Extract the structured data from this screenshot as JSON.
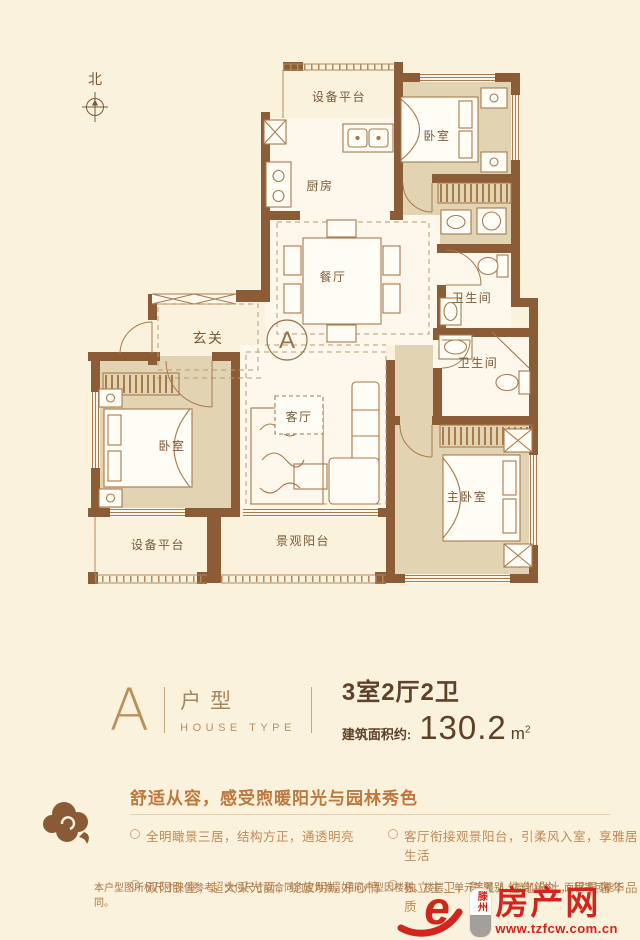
{
  "plan": {
    "compass": "北",
    "marker": "A",
    "rooms": {
      "equip_top": "设备平台",
      "kitchen": "厨房",
      "bedroom_tr": "卧室",
      "dining": "餐厅",
      "foyer": "玄关",
      "bath_1": "卫生间",
      "bath_2": "卫生间",
      "living": "客厅",
      "bedroom_left": "卧室",
      "master": "主卧室",
      "equip_bottom": "设备平台",
      "balcony": "景观阳台"
    }
  },
  "info": {
    "type_letter": "A",
    "type_label": "户型",
    "type_label_en": "HOUSE TYPE",
    "layout": "3室2厅2卫",
    "area_label": "建筑面积约:",
    "area_value": "130.2",
    "area_unit": "m",
    "area_sup": "2"
  },
  "features": {
    "headline": "舒适从容，感受煦暖阳光与园林秀色",
    "col1": [
      "全明瞰景三居，结构方正，通透明亮",
      "双阳卧室，超大采光面，绽放明媚好心情"
    ],
    "col2": [
      "客厅衔接观景阳台，引柔风入室，享雅居生活",
      "独立主卫，彰显人性化设计，尽显奢华品质"
    ]
  },
  "disclaimer": "本户型图所标尺寸仅供参考，交付尺寸以合同约定为准，相同户型因楼栋、楼层、单元等差别，局部结构、面积等可能不同。",
  "logo": {
    "city": "滕州",
    "name": "房产网",
    "url": "www.tzfcw.com.cn"
  },
  "colors": {
    "wall": "#8b5c36",
    "room_fill": "#e2d3b2",
    "accent_red": "#d2251c",
    "text_brown": "#5e4126",
    "headline_orange": "#c1763c"
  }
}
